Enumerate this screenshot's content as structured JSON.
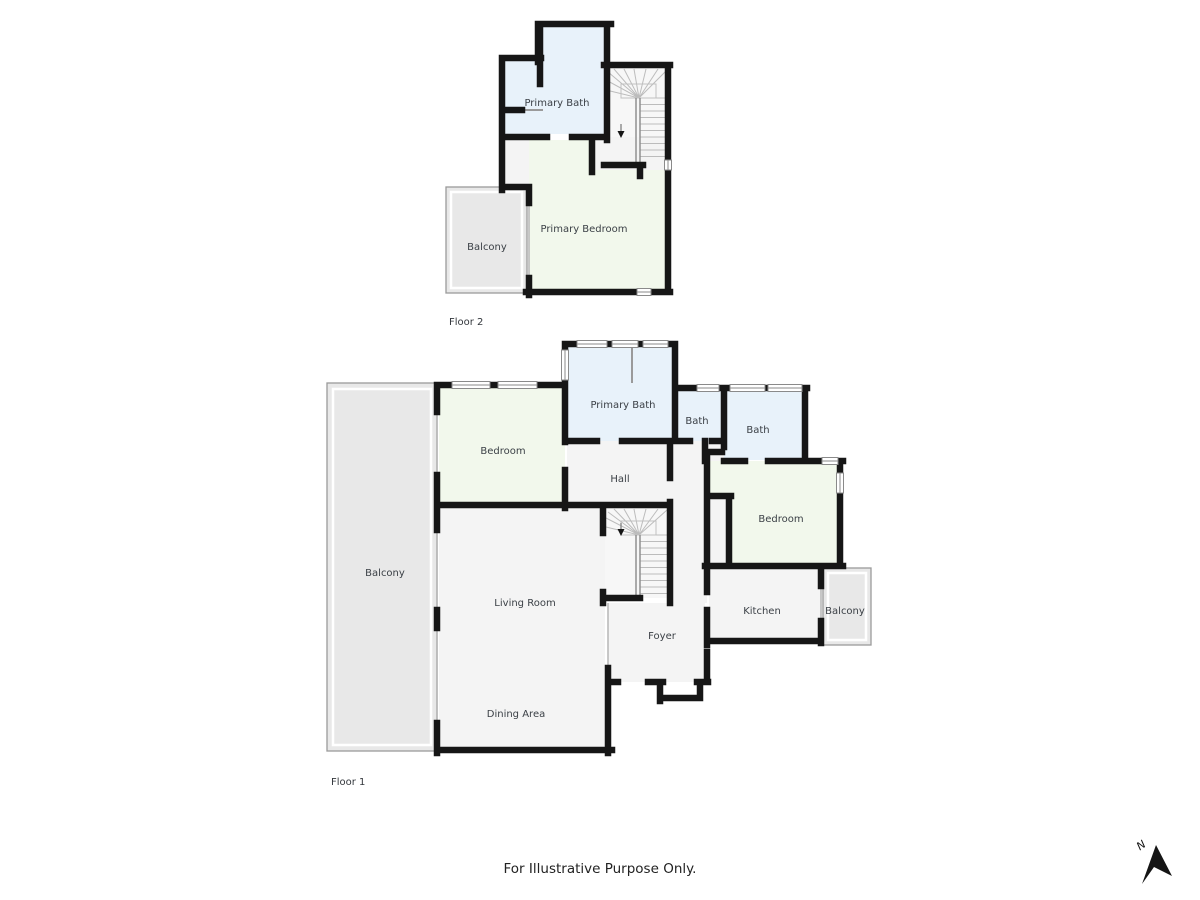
{
  "meta": {
    "disclaimer": "For Illustrative Purpose Only.",
    "north_label": "N"
  },
  "floor2": {
    "label": "Floor 2",
    "rooms": [
      {
        "label": "Primary Bath"
      },
      {
        "label": "Primary Bedroom"
      },
      {
        "label": "Balcony"
      }
    ]
  },
  "floor1": {
    "label": "Floor 1",
    "rooms": [
      {
        "label": "Primary Bath"
      },
      {
        "label": "Bath"
      },
      {
        "label": "Bath"
      },
      {
        "label": "Hall"
      },
      {
        "label": "Bedroom"
      },
      {
        "label": "Bedroom"
      },
      {
        "label": "Living Room"
      },
      {
        "label": "Dining Area"
      },
      {
        "label": "Foyer"
      },
      {
        "label": "Kitchen"
      },
      {
        "label": "Balcony"
      },
      {
        "label": "Balcony"
      }
    ]
  },
  "colors": {
    "wall": "#161616",
    "bath": "#e8f2fa",
    "bedroom": "#f2f8ec",
    "balcony": "#e8e8e8",
    "floor": "#f4f4f4",
    "stairs": "#f7f7f7"
  }
}
